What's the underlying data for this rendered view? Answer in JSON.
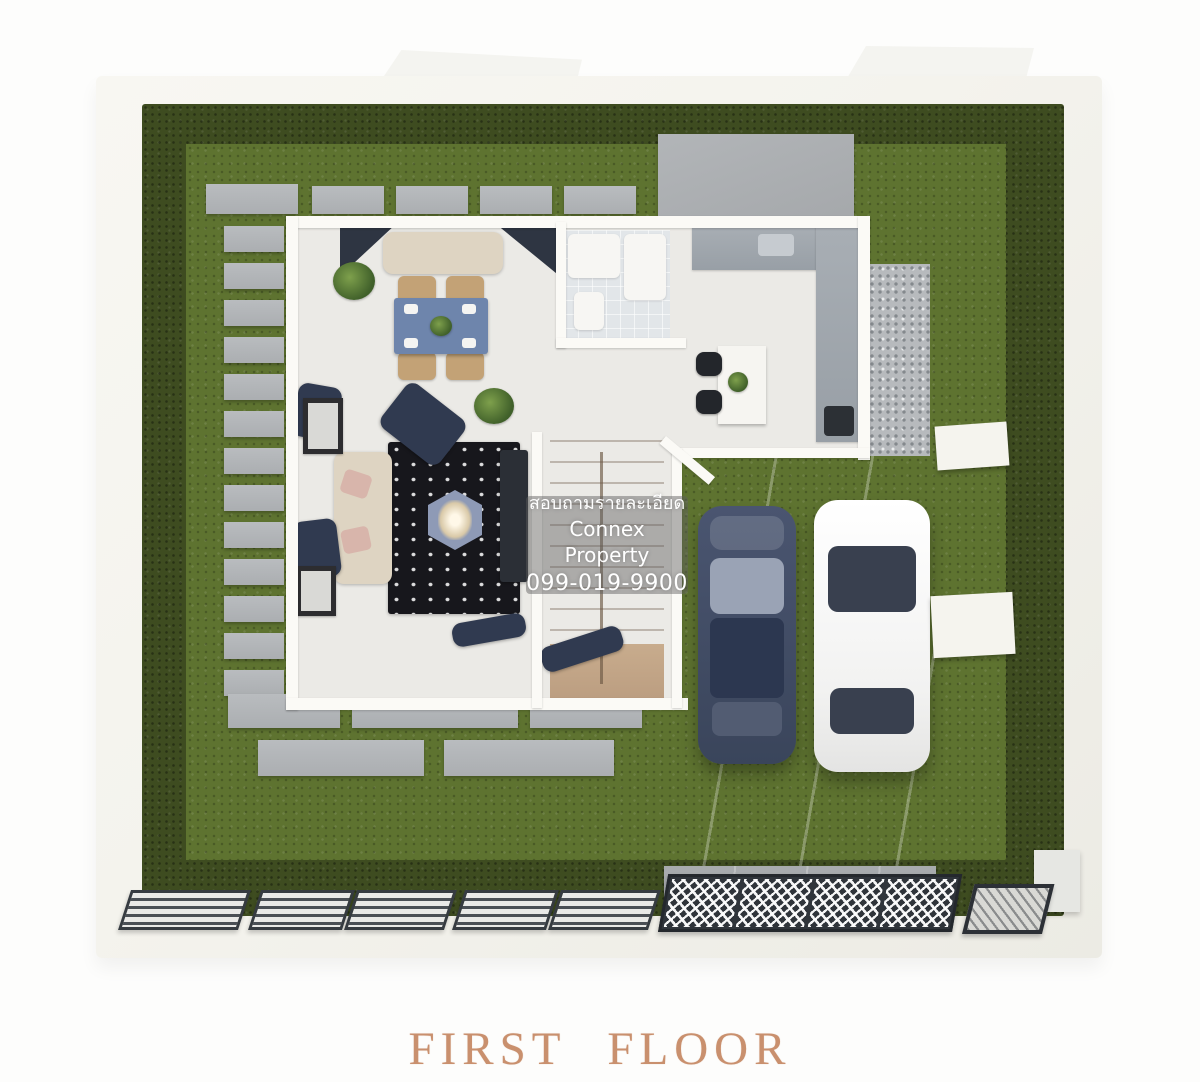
{
  "watermark": {
    "line1": "สอบถามรายละเอียด",
    "line2": "Connex Property",
    "line3": "099-019-9900"
  },
  "caption": {
    "text": "FIRST FLOOR"
  },
  "colors": {
    "page_bg": "#fdfdfc",
    "caption_text": "#c9906e",
    "wall_white": "#f4f3ed",
    "hedge_green": "#3e4c20",
    "grass_green": "#5e7330",
    "paver_gray": "#abaeb1",
    "patio_gray": "#a5a8ab",
    "house_floor": "#ebeae6",
    "inner_wall": "#fbfaf6",
    "bath_tile": "#e2e6e9",
    "counter_gray": "#989fa6",
    "island_white": "#f6f5f1",
    "stool_dark": "#23262b",
    "stair_wood": "#b3947a",
    "rug_dark": "#17171c",
    "dining_table_blue": "#6e85ac",
    "coffee_table_blue": "#8e9ab6",
    "sofa_beige": "#ded4c2",
    "navy_furniture": "#303a50",
    "carport_concrete": "#a2a5a8",
    "gravel_gray": "#b7babd",
    "car_dark_body": "#3a455b",
    "car_white_body": "#f2f2f1",
    "car_glass_dark": "#39404f",
    "fence_dark": "#363b41",
    "watermark_bg": "rgba(95,95,95,0.45)",
    "watermark_text": "#ffffff"
  }
}
